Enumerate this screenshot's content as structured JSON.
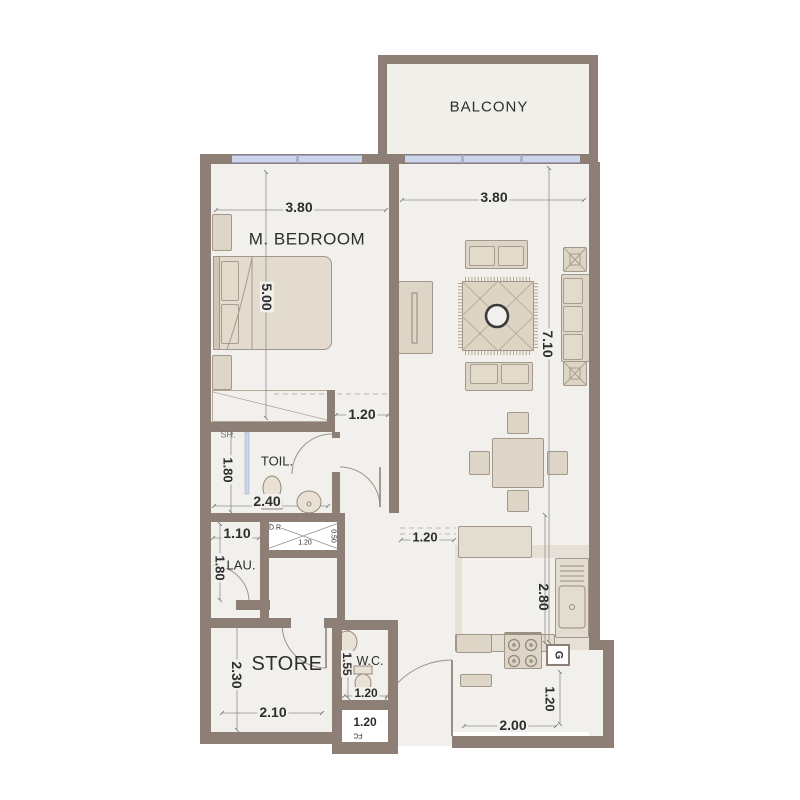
{
  "rooms": {
    "balcony": {
      "label": "BALCONY"
    },
    "bedroom": {
      "label": "M. BEDROOM",
      "width": "3.80",
      "depth": "5.00"
    },
    "living": {
      "width": "3.80",
      "depth": "7.10"
    },
    "hallway": {
      "width": "1.20"
    },
    "toilet": {
      "label": "TOIL.",
      "shower_label": "SH.",
      "width": "2.40",
      "depth": "1.80"
    },
    "shaft": {
      "label": "D.R",
      "width": "1.20",
      "depth": "0.50"
    },
    "laundry": {
      "label": "LAU.",
      "width": "1.10",
      "depth": "1.80"
    },
    "store": {
      "label": "STORE",
      "width": "2.10",
      "depth": "2.30"
    },
    "wc": {
      "label": "W.C.",
      "width": "1.20",
      "depth": "1.55"
    },
    "fc": {
      "label": "FC",
      "width": "1.20"
    },
    "kitchen": {
      "depth": "2.80",
      "passage": "1.20",
      "gas_label": "G"
    },
    "entry": {
      "width": "2.00",
      "depth": "1.20"
    }
  },
  "colors": {
    "wall": "#8d7e76",
    "floor": "#f2f0ec",
    "kitchen_floor": "#e7e0d6",
    "furniture": "#ddd5c6",
    "window": "#cdd5ea",
    "dim_text": "#2d2d2d"
  }
}
